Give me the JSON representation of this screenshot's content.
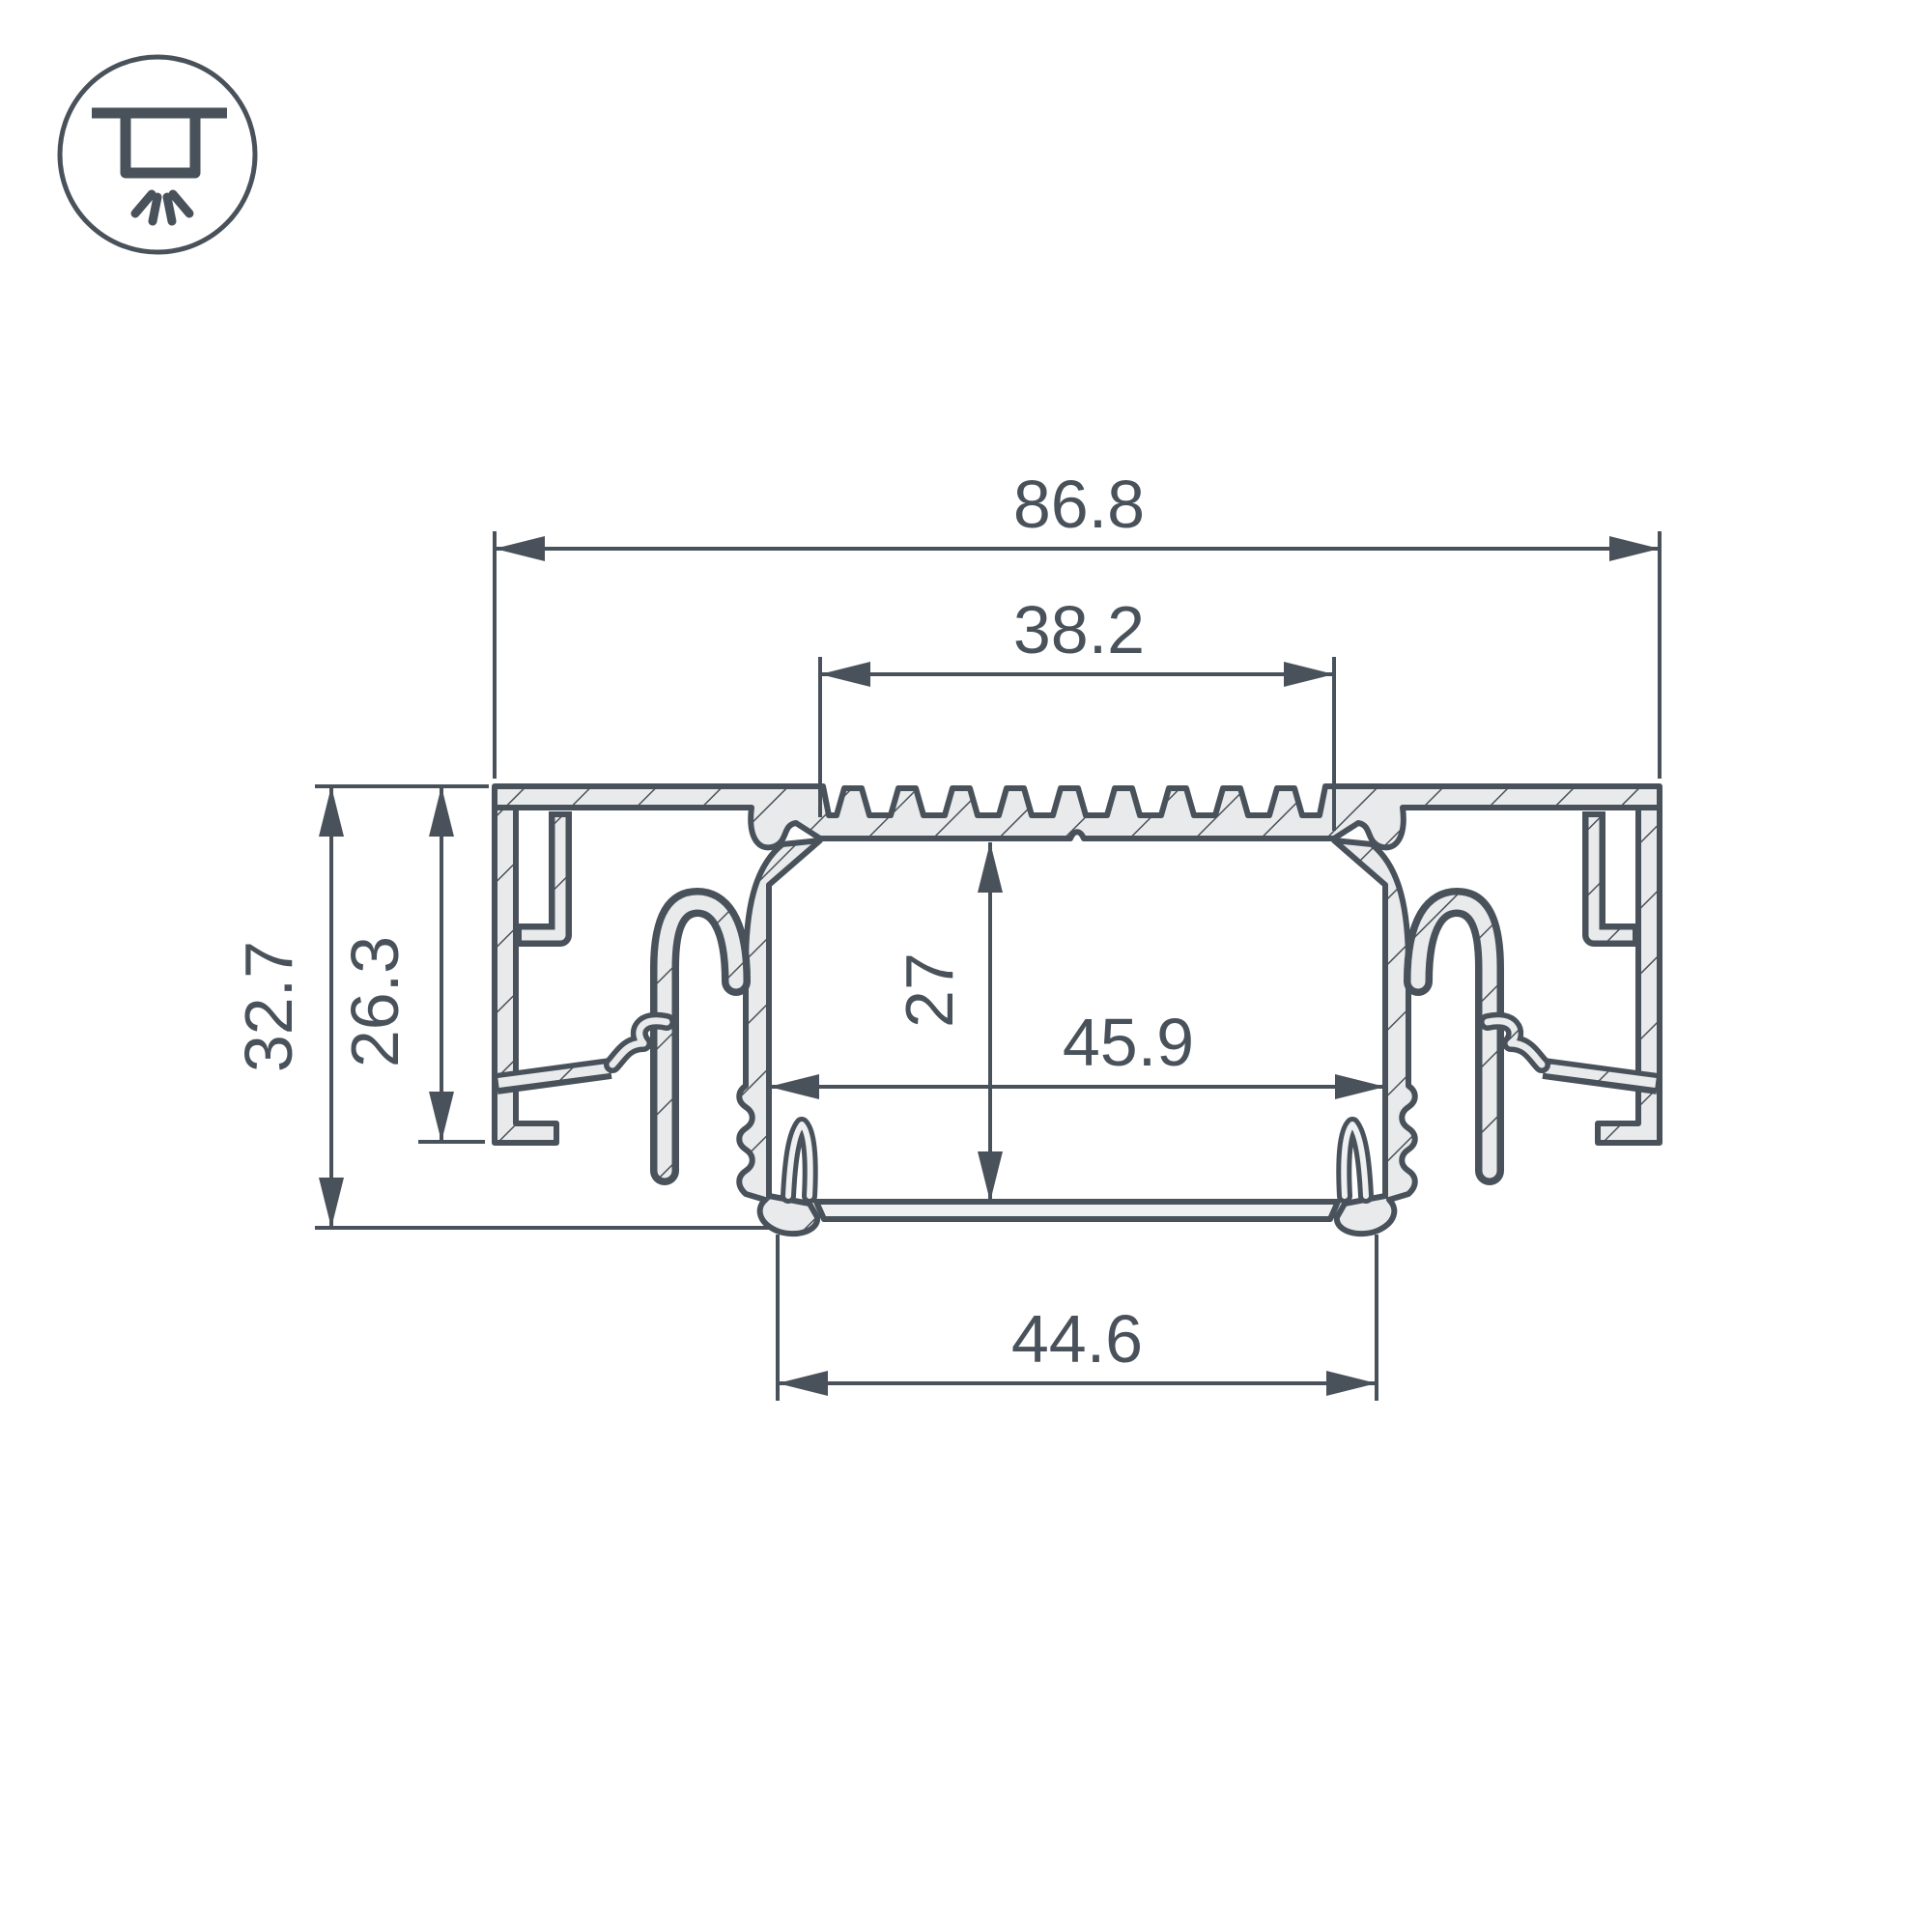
{
  "drawing": {
    "type": "profile-cross-section",
    "icon": "recessed-ceiling-light",
    "colors": {
      "line": "#49525a",
      "fill": "#e9eaeb",
      "background": "#ffffff"
    },
    "dimensions": {
      "overall_width": "86.8",
      "top_opening_width": "38.2",
      "overall_height": "32.7",
      "flange_height": "26.3",
      "channel_depth": "27",
      "channel_inner_width": "45.9",
      "bottom_width": "44.6"
    }
  }
}
